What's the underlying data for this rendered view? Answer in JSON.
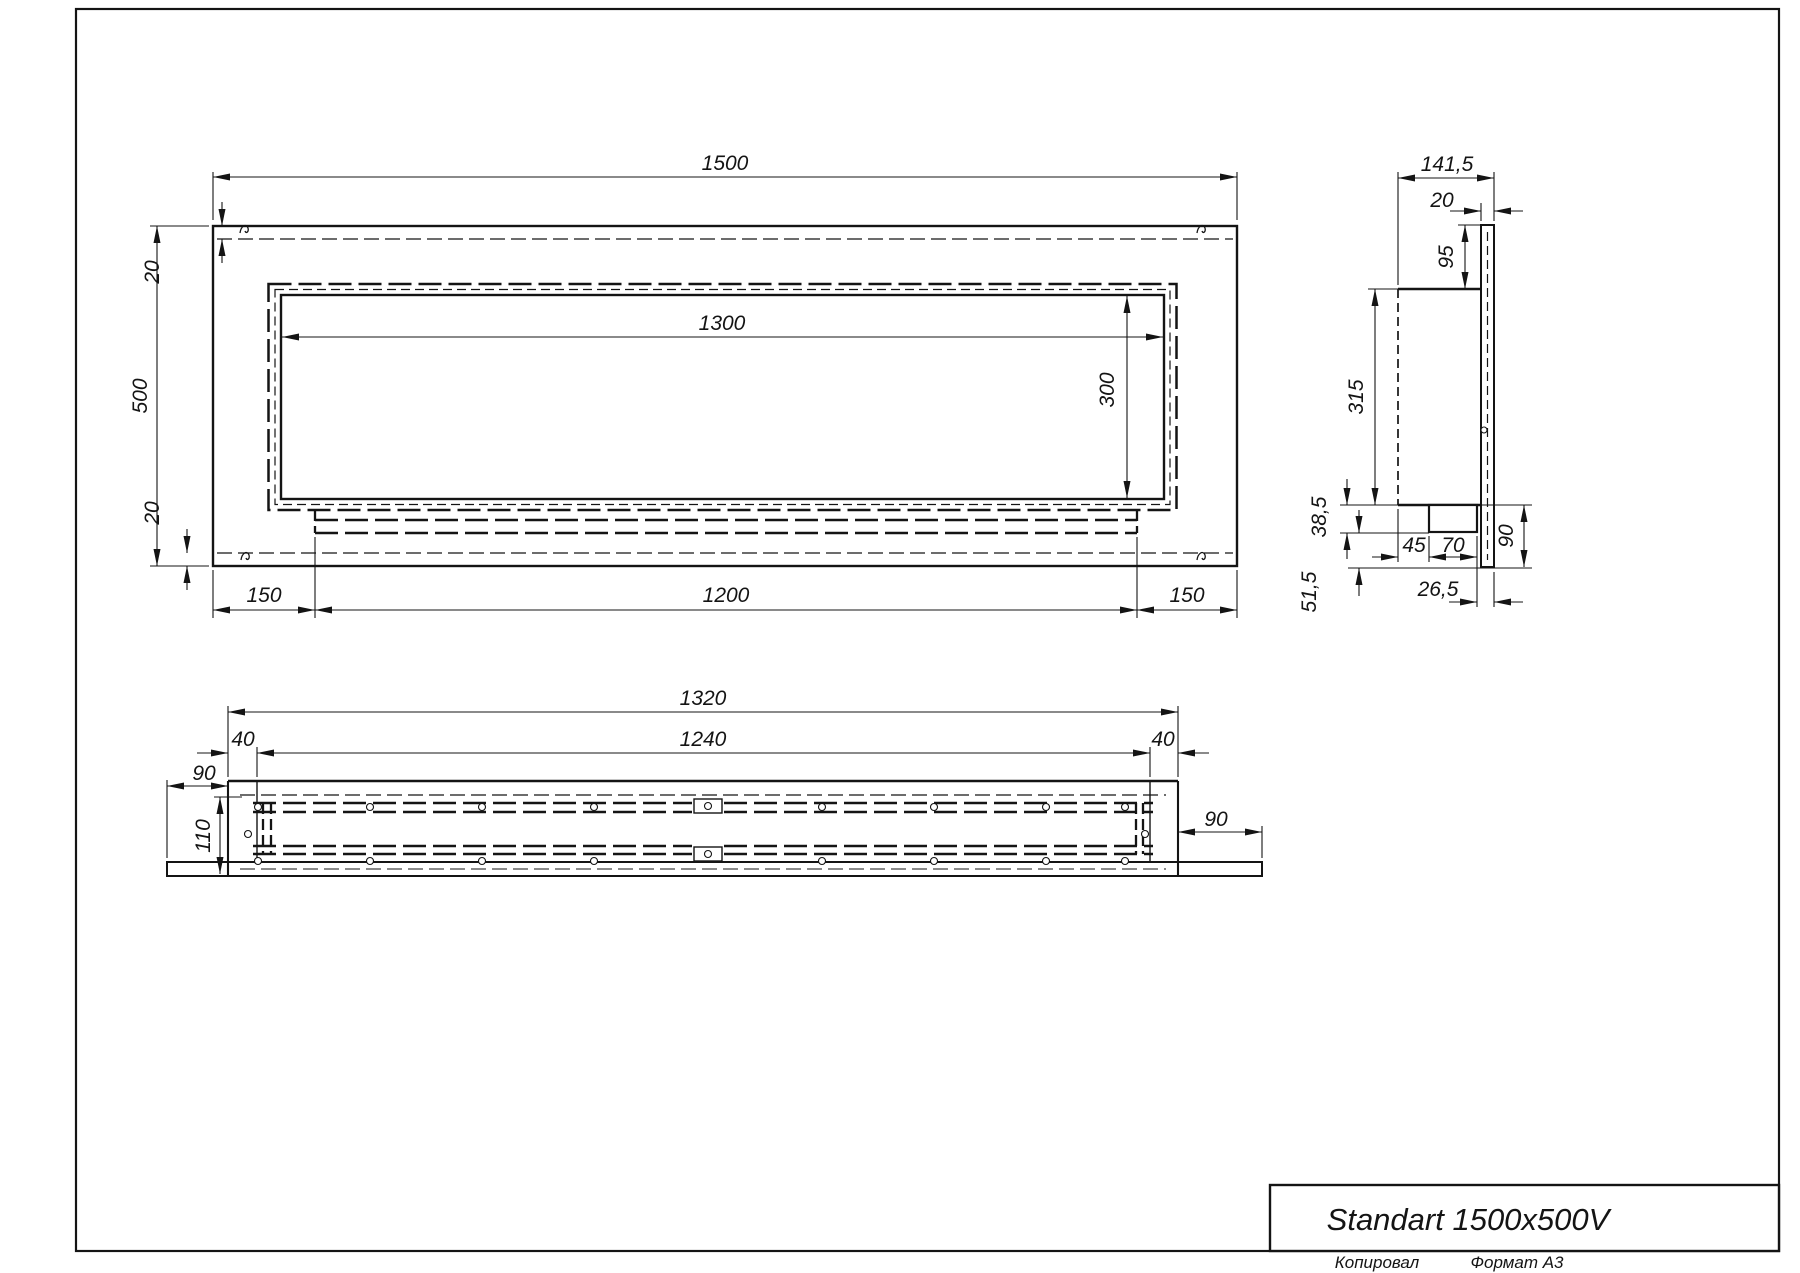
{
  "title_block": {
    "title": "Standart 1500x500V"
  },
  "footer": {
    "copied": "Копировал",
    "format": "Формат А3"
  },
  "front": {
    "width": "1500",
    "height": "500",
    "inset_top": "20",
    "inset_bottom": "20",
    "opening_width": "1300",
    "opening_height": "300",
    "margin_left": "150",
    "tray_width": "1200",
    "margin_right": "150"
  },
  "side": {
    "depth": "141,5",
    "wall": "20",
    "flange": "95",
    "body": "315",
    "step_height": "38,5",
    "step_offset": "45",
    "step_width": "70",
    "drop": "90",
    "edge_offset": "26,5",
    "bottom_drop": "51,5"
  },
  "bottom": {
    "outer_width": "1320",
    "inner_width": "1240",
    "wall_left": "40",
    "wall_right": "40",
    "lip_left": "90",
    "lip_right": "90",
    "depth": "110"
  }
}
